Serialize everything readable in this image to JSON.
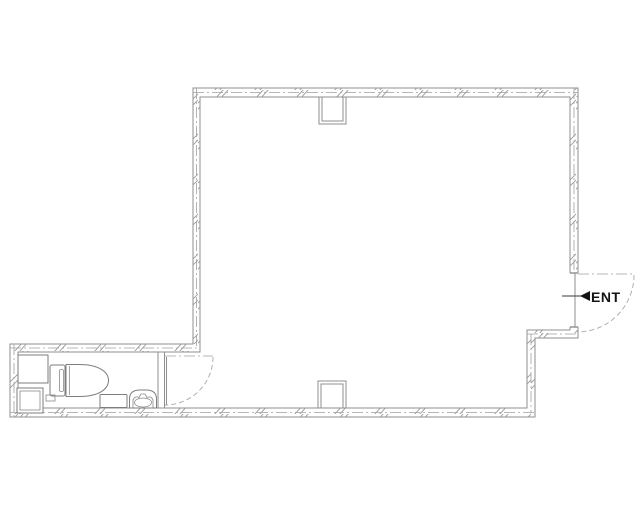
{
  "page": {
    "background": "#ffffff"
  },
  "colors": {
    "wall_line": "#8f8f8f",
    "centerline": "#a0a0a0",
    "fixture_line": "#7d7d7d",
    "entrance_text": "#141414"
  },
  "entrance": {
    "label": "ENT",
    "arrow_icon": "left-solid-triangle"
  },
  "fixtures": {
    "toilet": "toilet-plan-view",
    "basin": "hand-wash-basin",
    "cabinet": "low-cabinet",
    "pipe_shaft": "pipe-shaft-box",
    "counter": "corner-counter",
    "columns": [
      "top-wall-column",
      "bottom-wall-column"
    ],
    "doors": [
      "entrance-swing-door",
      "bathroom-swing-door"
    ]
  }
}
